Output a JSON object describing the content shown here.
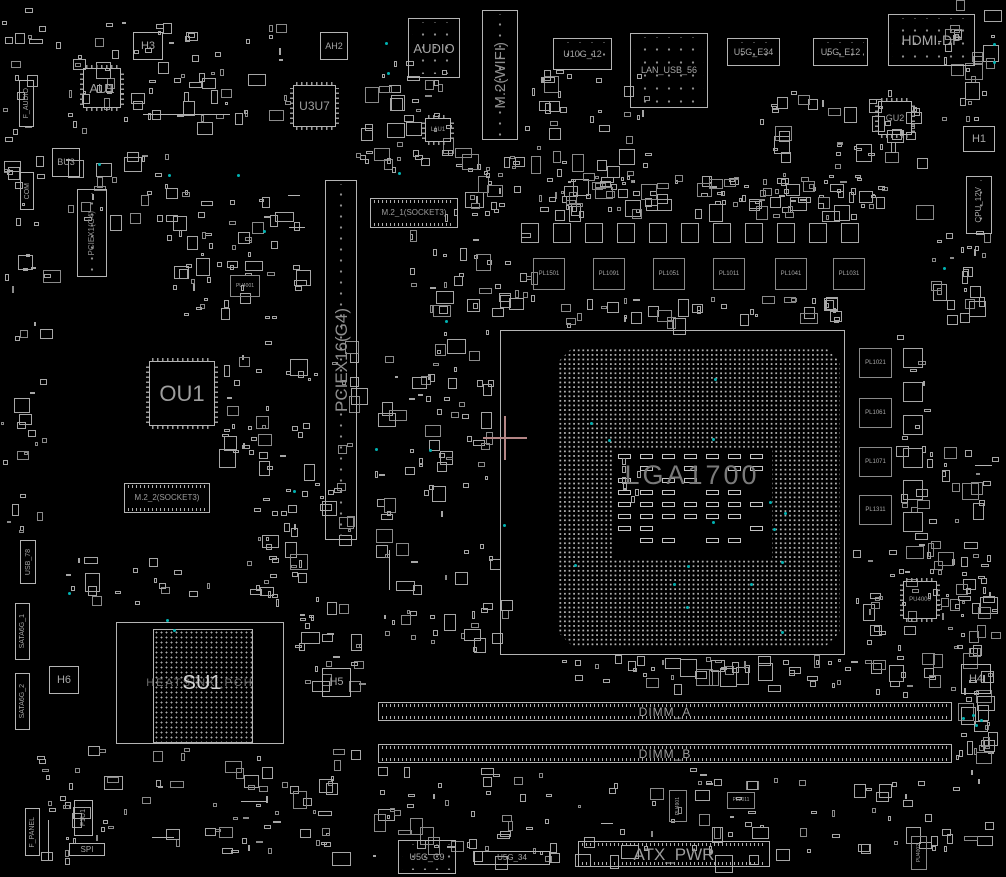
{
  "board": {
    "colors": {
      "background": "#000000",
      "outline": "#b4b4b4",
      "outline_dim": "#8a8a8a",
      "label": "#a6a6a6",
      "label_bright": "#d2d2d2",
      "label_faint": "#6e6e6e",
      "socket_label": "#7a7a7a",
      "teal_highlight": "#00b2b2",
      "crosshair": "#b48585"
    }
  },
  "components": [
    {
      "n": "f-audio-header",
      "l": "F_AUDIO",
      "t": "vbox",
      "x": 19,
      "y": 80,
      "w": 15,
      "h": 47,
      "fs": 7
    },
    {
      "n": "com-header",
      "l": "COM",
      "t": "vbox",
      "x": 20,
      "y": 172,
      "w": 14,
      "h": 38,
      "fs": 7
    },
    {
      "n": "h3-box",
      "l": "H3",
      "t": "box",
      "x": 133,
      "y": 32,
      "w": 30,
      "h": 28,
      "fs": 11
    },
    {
      "n": "chip-au1",
      "l": "AU1",
      "t": "chip",
      "x": 83,
      "y": 68,
      "w": 38,
      "h": 40,
      "fs": 13
    },
    {
      "n": "ah2-box",
      "l": "AH2",
      "t": "box",
      "x": 320,
      "y": 32,
      "w": 28,
      "h": 28,
      "fs": 9
    },
    {
      "n": "chip-u3u7",
      "l": "U3U7",
      "t": "chip",
      "x": 293,
      "y": 85,
      "w": 43,
      "h": 42,
      "fs": 12
    },
    {
      "n": "bu3-box",
      "l": "BU3",
      "t": "box",
      "x": 52,
      "y": 148,
      "w": 28,
      "h": 29,
      "fs": 9
    },
    {
      "n": "pciex1-slot",
      "l": "PCIEX1(G4)",
      "t": "slotv",
      "x": 77,
      "y": 189,
      "w": 30,
      "h": 88,
      "fs": 8
    },
    {
      "n": "pu4001-box",
      "l": "PU4001",
      "t": "box",
      "x": 230,
      "y": 275,
      "w": 30,
      "h": 22,
      "fs": 5,
      "d": 1
    },
    {
      "n": "audio-connector",
      "l": "AUDIO",
      "t": "conn",
      "x": 408,
      "y": 18,
      "w": 52,
      "h": 60,
      "fs": 13
    },
    {
      "n": "m2-wifi-slot",
      "l": "M.2(WIFI)",
      "t": "slotv",
      "x": 482,
      "y": 10,
      "w": 36,
      "h": 130,
      "fs": 15
    },
    {
      "n": "chip-l1u1",
      "l": "L1U1",
      "t": "chip",
      "x": 425,
      "y": 118,
      "w": 26,
      "h": 24,
      "fs": 6
    },
    {
      "n": "u10g-12-connector",
      "l": "U10G_12",
      "t": "conn",
      "x": 553,
      "y": 38,
      "w": 59,
      "h": 32,
      "fs": 9
    },
    {
      "n": "lan-usb-56-connector",
      "l": "LAN_USB_56",
      "t": "conn",
      "x": 630,
      "y": 33,
      "w": 78,
      "h": 75,
      "fs": 9
    },
    {
      "n": "u5g-e34-connector",
      "l": "U5G_E34",
      "t": "conn",
      "x": 727,
      "y": 38,
      "w": 53,
      "h": 28,
      "fs": 9
    },
    {
      "n": "u5g-e12-connector",
      "l": "U5G_E12",
      "t": "conn",
      "x": 813,
      "y": 38,
      "w": 55,
      "h": 28,
      "fs": 9
    },
    {
      "n": "hdmi-dp-connector",
      "l": "HDMI-DP",
      "t": "conn",
      "x": 888,
      "y": 14,
      "w": 87,
      "h": 52,
      "fs": 14
    },
    {
      "n": "chip-gu2",
      "l": "GU2",
      "t": "chip",
      "x": 878,
      "y": 101,
      "w": 34,
      "h": 34,
      "fs": 9
    },
    {
      "n": "h1-box",
      "l": "H1",
      "t": "box",
      "x": 963,
      "y": 126,
      "w": 32,
      "h": 26,
      "fs": 11
    },
    {
      "n": "cpu-12v-connector",
      "l": "CPU_12V",
      "t": "vconn",
      "x": 966,
      "y": 176,
      "w": 26,
      "h": 58,
      "fs": 8
    },
    {
      "n": "m2-1-socket3-slot",
      "l": "M.2_1(SOCKET3)",
      "t": "hslot",
      "x": 370,
      "y": 198,
      "w": 88,
      "h": 30,
      "fs": 8
    },
    {
      "n": "pciex16-slot",
      "l": "PCIEX16(G4)",
      "t": "slotv",
      "x": 325,
      "y": 180,
      "w": 32,
      "h": 360,
      "fs": 17
    },
    {
      "n": "pl1501-box",
      "l": "PL1501",
      "t": "box",
      "x": 533,
      "y": 258,
      "w": 32,
      "h": 32,
      "fs": 6,
      "d": 1
    },
    {
      "n": "pl1091-box",
      "l": "PL1091",
      "t": "box",
      "x": 593,
      "y": 258,
      "w": 32,
      "h": 32,
      "fs": 6,
      "d": 1
    },
    {
      "n": "pl1051-box",
      "l": "PL1051",
      "t": "box",
      "x": 653,
      "y": 258,
      "w": 32,
      "h": 32,
      "fs": 6,
      "d": 1
    },
    {
      "n": "pl1011-box",
      "l": "PL1011",
      "t": "box",
      "x": 713,
      "y": 258,
      "w": 32,
      "h": 32,
      "fs": 6,
      "d": 1
    },
    {
      "n": "pl1041-box",
      "l": "PL1041",
      "t": "box",
      "x": 775,
      "y": 258,
      "w": 32,
      "h": 32,
      "fs": 6,
      "d": 1
    },
    {
      "n": "pl1031-box",
      "l": "PL1031",
      "t": "box",
      "x": 833,
      "y": 258,
      "w": 32,
      "h": 32,
      "fs": 6,
      "d": 1
    },
    {
      "n": "pl1021-box",
      "l": "PL1021",
      "t": "box",
      "x": 859,
      "y": 348,
      "w": 33,
      "h": 30,
      "fs": 6,
      "d": 1
    },
    {
      "n": "pl1061-box",
      "l": "PL1061",
      "t": "box",
      "x": 859,
      "y": 398,
      "w": 33,
      "h": 30,
      "fs": 6,
      "d": 1
    },
    {
      "n": "pl1071-box",
      "l": "PL1071",
      "t": "box",
      "x": 859,
      "y": 447,
      "w": 33,
      "h": 30,
      "fs": 6,
      "d": 1
    },
    {
      "n": "pl1311-box",
      "l": "PL1311",
      "t": "box",
      "x": 859,
      "y": 495,
      "w": 33,
      "h": 30,
      "fs": 6,
      "d": 1
    },
    {
      "n": "chip-pu4000",
      "l": "PU4000",
      "t": "chip",
      "x": 903,
      "y": 581,
      "w": 34,
      "h": 38,
      "fs": 6
    },
    {
      "n": "h4-box",
      "l": "H4",
      "t": "box",
      "x": 961,
      "y": 664,
      "w": 30,
      "h": 30,
      "fs": 11
    },
    {
      "n": "usb-78-header",
      "l": "USB_78",
      "t": "vbox",
      "x": 20,
      "y": 540,
      "w": 16,
      "h": 44,
      "fs": 7
    },
    {
      "n": "sata6g-1-connector",
      "l": "SATA6G_1",
      "t": "vbox",
      "x": 15,
      "y": 603,
      "w": 15,
      "h": 57,
      "fs": 7
    },
    {
      "n": "sata6g-2-connector",
      "l": "SATA6G_2",
      "t": "vbox",
      "x": 15,
      "y": 673,
      "w": 15,
      "h": 57,
      "fs": 7
    },
    {
      "n": "h6-box",
      "l": "H6",
      "t": "box",
      "x": 49,
      "y": 666,
      "w": 30,
      "h": 28,
      "fs": 11
    },
    {
      "n": "pch-su1",
      "l": "SU1",
      "l2": "HEATSINK_PCH",
      "t": "pch",
      "x": 116,
      "y": 622,
      "w": 168,
      "h": 122,
      "chip": [
        36,
        6,
        100,
        114
      ],
      "fs": 20,
      "fs2": 11
    },
    {
      "n": "h5-box",
      "l": "H5",
      "t": "box",
      "x": 322,
      "y": 668,
      "w": 29,
      "h": 29,
      "fs": 11
    },
    {
      "n": "chip-ou1",
      "l": "OU1",
      "t": "chip",
      "x": 149,
      "y": 361,
      "w": 66,
      "h": 65,
      "fs": 22
    },
    {
      "n": "m2-2-socket3-slot",
      "l": "M.2_2(SOCKET3)",
      "t": "hslot",
      "x": 124,
      "y": 483,
      "w": 86,
      "h": 30,
      "fs": 8
    },
    {
      "n": "f1u1-header",
      "l": "F1U1",
      "t": "vbox",
      "x": 74,
      "y": 800,
      "w": 19,
      "h": 36,
      "fs": 7
    },
    {
      "n": "f-panel-header",
      "l": "F_PANEL",
      "t": "vbox",
      "x": 25,
      "y": 808,
      "w": 15,
      "h": 48,
      "fs": 7
    },
    {
      "n": "spi-header",
      "l": "SPI",
      "t": "box",
      "x": 69,
      "y": 843,
      "w": 36,
      "h": 13,
      "fs": 8
    },
    {
      "n": "dimm-a-slot",
      "l": "DIMM_A",
      "t": "dimm",
      "x": 378,
      "y": 702,
      "w": 574,
      "h": 19,
      "fs": 12
    },
    {
      "n": "dimm-b-slot",
      "l": "DIMM_B",
      "t": "dimm",
      "x": 378,
      "y": 744,
      "w": 574,
      "h": 19,
      "fs": 12
    },
    {
      "n": "u5g-c9-connector",
      "l": "U5G_C9",
      "t": "conn",
      "x": 398,
      "y": 840,
      "w": 58,
      "h": 34,
      "fs": 9
    },
    {
      "n": "u5g-34-connector",
      "l": "U5G_34",
      "t": "box",
      "x": 474,
      "y": 851,
      "w": 76,
      "h": 14,
      "fs": 8
    },
    {
      "n": "atx-pwr-connector",
      "l": "ATX_PWR",
      "t": "hslot",
      "x": 578,
      "y": 841,
      "w": 192,
      "h": 26,
      "fs": 17
    },
    {
      "n": "pu4901-box",
      "l": "PU4901",
      "t": "vbox",
      "x": 669,
      "y": 790,
      "w": 18,
      "h": 32,
      "fs": 5,
      "d": 1
    },
    {
      "n": "pl2011-box",
      "l": "PL2011",
      "t": "box",
      "x": 727,
      "y": 792,
      "w": 28,
      "h": 17,
      "fs": 5,
      "d": 1
    },
    {
      "n": "pu4002-box",
      "l": "PU4002",
      "t": "vbox",
      "x": 911,
      "y": 836,
      "w": 16,
      "h": 34,
      "fs": 5,
      "d": 1
    }
  ],
  "socket": {
    "name": "cpu-socket",
    "label": "LGA1700",
    "keepout": [
      500,
      330,
      345,
      325
    ],
    "grid": [
      558,
      348,
      282,
      298
    ],
    "cavity": [
      612,
      448,
      160,
      112
    ]
  },
  "chokes": {
    "top": {
      "y": 223,
      "w": 18,
      "h": 20,
      "xs": [
        521,
        553,
        585,
        617,
        649,
        681,
        713,
        745,
        777,
        809,
        841
      ]
    },
    "right": {
      "x": 903,
      "w": 20,
      "h": 20,
      "ys": [
        348,
        382,
        415,
        448,
        480,
        512
      ]
    }
  },
  "clusters": [
    [
      55,
      20,
      250,
      120,
      70,
      1
    ],
    [
      60,
      150,
      120,
      80,
      25,
      2
    ],
    [
      160,
      185,
      155,
      150,
      55,
      3
    ],
    [
      218,
      340,
      150,
      140,
      45,
      4
    ],
    [
      355,
      60,
      120,
      120,
      40,
      5
    ],
    [
      520,
      70,
      150,
      150,
      55,
      6
    ],
    [
      440,
      150,
      90,
      80,
      30,
      7
    ],
    [
      540,
      175,
      335,
      48,
      85,
      8
    ],
    [
      755,
      90,
      180,
      140,
      65,
      9
    ],
    [
      938,
      0,
      68,
      130,
      25,
      10
    ],
    [
      0,
      0,
      55,
      240,
      25,
      11
    ],
    [
      0,
      250,
      60,
      300,
      30,
      12
    ],
    [
      375,
      330,
      130,
      270,
      70,
      13
    ],
    [
      408,
      230,
      140,
      90,
      35,
      14
    ],
    [
      850,
      540,
      150,
      165,
      70,
      15
    ],
    [
      895,
      330,
      55,
      240,
      20,
      16
    ],
    [
      40,
      555,
      300,
      60,
      30,
      17
    ],
    [
      35,
      745,
      330,
      125,
      80,
      18
    ],
    [
      370,
      765,
      630,
      105,
      120,
      19
    ],
    [
      940,
      430,
      66,
      280,
      40,
      20
    ],
    [
      955,
      695,
      50,
      75,
      20,
      21
    ],
    [
      248,
      480,
      120,
      110,
      30,
      22
    ],
    [
      375,
      600,
      165,
      60,
      22,
      23
    ],
    [
      560,
      655,
      300,
      42,
      45,
      24
    ],
    [
      540,
      296,
      310,
      40,
      40,
      25
    ],
    [
      930,
      230,
      76,
      100,
      25,
      26
    ],
    [
      285,
      600,
      90,
      100,
      25,
      27
    ]
  ],
  "teal_dots": [
    [
      385,
      42
    ],
    [
      387,
      72
    ],
    [
      98,
      163
    ],
    [
      168,
      174
    ],
    [
      237,
      174
    ],
    [
      263,
      230
    ],
    [
      398,
      172
    ],
    [
      445,
      320
    ],
    [
      503,
      524
    ],
    [
      712,
      521
    ],
    [
      68,
      592
    ],
    [
      166,
      619
    ],
    [
      173,
      629
    ],
    [
      943,
      267
    ],
    [
      993,
      43
    ],
    [
      993,
      61
    ],
    [
      975,
      724
    ],
    [
      962,
      717
    ],
    [
      972,
      714
    ],
    [
      980,
      719
    ],
    [
      293,
      490
    ],
    [
      375,
      448
    ],
    [
      429,
      449
    ]
  ],
  "lines": [
    [
      143,
      114,
      87,
      1
    ],
    [
      975,
      465,
      17,
      1
    ],
    [
      601,
      823,
      12,
      1
    ],
    [
      152,
      837,
      22,
      1
    ],
    [
      241,
      801,
      26,
      1
    ],
    [
      288,
      195,
      12,
      1
    ],
    [
      289,
      227,
      16,
      1
    ],
    [
      48,
      820,
      1,
      40
    ],
    [
      389,
      550,
      1,
      40
    ]
  ],
  "crosshair": {
    "x": 505,
    "y": 438,
    "arm": 22
  }
}
